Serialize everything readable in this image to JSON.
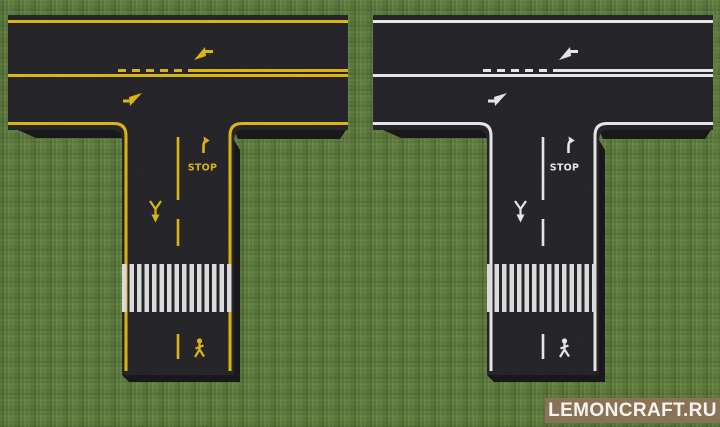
{
  "watermark": {
    "label": "LEMONCRAFT.RU",
    "bg_color": "#8a7354",
    "text_color": "#f5f3ef"
  },
  "roads": {
    "left": {
      "marking_color": "#d9af12",
      "stop_label": "STOP"
    },
    "right": {
      "marking_color": "#e3e3e3",
      "stop_label": "STOP"
    }
  },
  "colors": {
    "grass": "#567237",
    "asphalt": "#232327",
    "asphalt_side": "#17171a",
    "crosswalk_stripe": "#d8d8d8"
  },
  "icons": [
    "turn-arrow-icon",
    "right-turn-ahead-arrow-icon",
    "merge-arrow-icon",
    "pedestrian-icon",
    "zebra-crosswalk"
  ]
}
